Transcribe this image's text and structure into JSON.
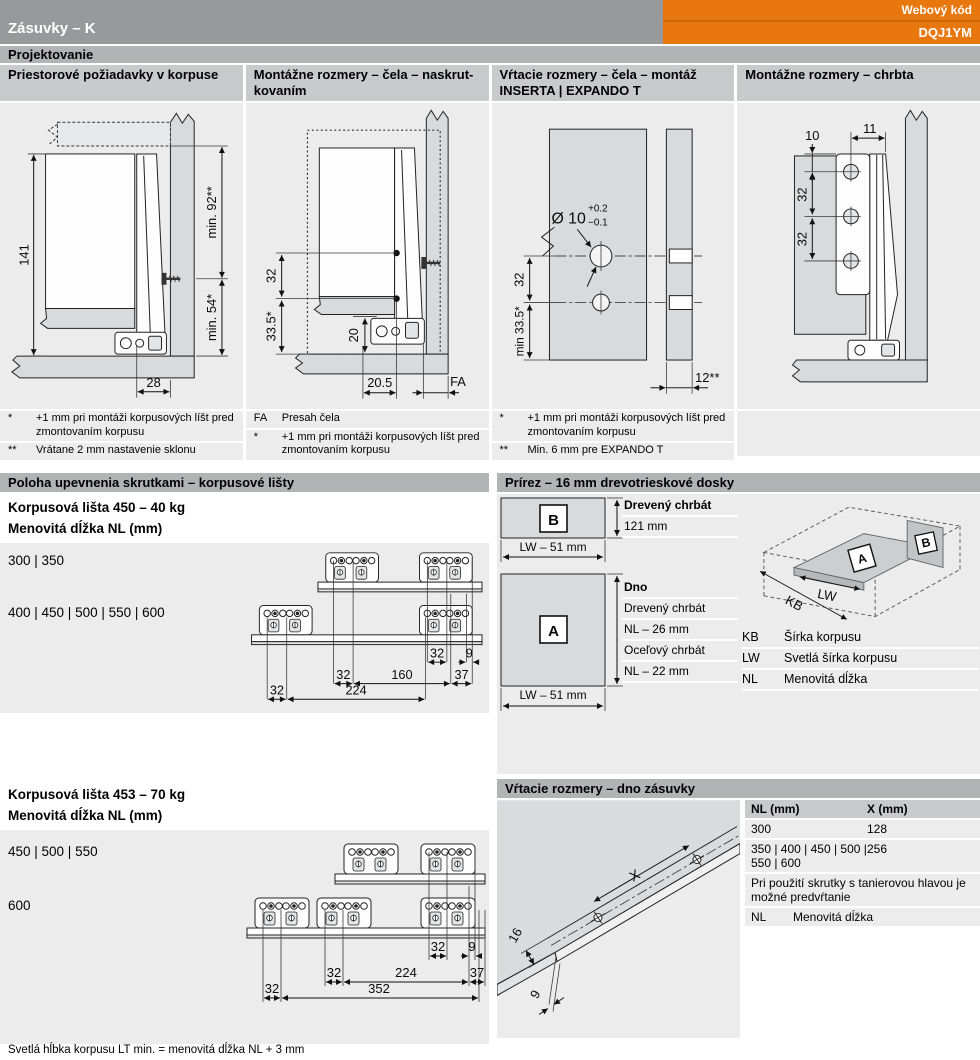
{
  "header": {
    "title": "Zásuvky – K",
    "web_code_label": "Webový kód",
    "web_code": "DQJ1YM"
  },
  "projektovanie": "Projektovanie",
  "col1": {
    "title": "Priestorové požiadavky v korpuse",
    "d141": "141",
    "d_min92": "min. 92**",
    "d_min54": "min. 54*",
    "d28": "28",
    "fn": [
      {
        "sym": "*",
        "text": "+1 mm pri montáži korpusových líšt pred zmontovaním korpusu"
      },
      {
        "sym": "**",
        "text": "Vrátane 2 mm nastavenie sklonu"
      }
    ]
  },
  "col2": {
    "title1": "Montážne rozmery – čela – naskrut-",
    "title2": "kovaním",
    "d32": "32",
    "d33_5": "33.5*",
    "d20": "20",
    "d20_5": "20.5",
    "dFA": "FA",
    "fn": [
      {
        "sym": "FA",
        "text": "Presah čela"
      },
      {
        "sym": "*",
        "text": "+1 mm pri montáži korpusových líšt pred zmontovaním korpusu"
      }
    ]
  },
  "col3": {
    "title1": "Vŕtacie rozmery – čela – montáž",
    "title2": "INSERTA | EXPANDO T",
    "dia": "Ø 10",
    "tol_p": "+0.2",
    "tol_m": "−0.1",
    "d32": "32",
    "d33_5": "min 33.5*",
    "d12": "12**",
    "fn": [
      {
        "sym": "*",
        "text": "+1 mm pri montáži korpusových líšt pred zmontovaním korpusu"
      },
      {
        "sym": "**",
        "text": "Min. 6 mm pre EXPANDO T"
      }
    ]
  },
  "col4": {
    "title": "Montážne rozmery – chrbta",
    "d10": "10",
    "d11": "11",
    "d32a": "32",
    "d32b": "32"
  },
  "rails": {
    "bar_title": "Poloha upevnenia skrutkami – korpusové lišty",
    "b40": {
      "name": "Korpusová lišta 450 – 40 kg",
      "nl": "Menovitá dĺžka NL (mm)",
      "row1": "300 | 350",
      "row2": "400 | 450 | 500 | 550 | 600",
      "a32": "32",
      "a9": "9",
      "b32": "32",
      "b160": "160",
      "b37": "37",
      "c32": "32",
      "c224": "224"
    },
    "b70": {
      "name": "Korpusová lišta 453 – 70 kg",
      "nl": "Menovitá dĺžka NL (mm)",
      "row1": "450 | 500 | 550",
      "row2": "600",
      "a32": "32",
      "a9": "9",
      "b32": "32",
      "b224": "224",
      "b37": "37",
      "c32": "32",
      "c352": "352"
    }
  },
  "prirez": {
    "bar_title": "Prírez – 16 mm drevotrieskové dosky",
    "b_label": "B",
    "a_label": "A",
    "lw51_b": "LW – 51 mm",
    "lw51_a": "LW – 51 mm",
    "b_head": "Drevený chrbát",
    "b_h": "121 mm",
    "a_head": "Dno",
    "a_r1": "Drevený chrbát",
    "a_r2": "NL – 26 mm",
    "a_r3": "Oceľový chrbát",
    "a_r4": "NL – 22 mm",
    "iso_a": "A",
    "iso_b": "B",
    "iso_lw": "LW",
    "iso_kb": "KB",
    "legend": [
      {
        "k": "KB",
        "v": "Šírka korpusu"
      },
      {
        "k": "LW",
        "v": "Svetlá šírka korpusu"
      },
      {
        "k": "NL",
        "v": "Menovitá dĺžka"
      }
    ]
  },
  "drill": {
    "bar_title": "Vŕtacie rozmery – dno zásuvky",
    "h_nl": "NL (mm)",
    "h_x": "X (mm)",
    "r1_nl": "300",
    "r1_x": "128",
    "r2_nl": "350 | 400 | 450 | 500 | 550 | 600",
    "r2_x": "256",
    "note": "Pri použití skrutky s tanierovou hlavou je možné predvŕtanie",
    "abbr": "NL",
    "abbr_v": "Menovitá dĺžka",
    "dX": "X",
    "d16": "16",
    "d9": "9"
  },
  "footer": "Svetlá hĺbka korpusu LT min. = menovitá dĺžka NL + 3 mm",
  "colors": {
    "accent_orange": "#e8770e",
    "header_gray": "#97999b",
    "section_bar_gray": "#b2b3b5",
    "title_bar_gray": "#c9cacc",
    "panel_gray": "#ececed"
  }
}
